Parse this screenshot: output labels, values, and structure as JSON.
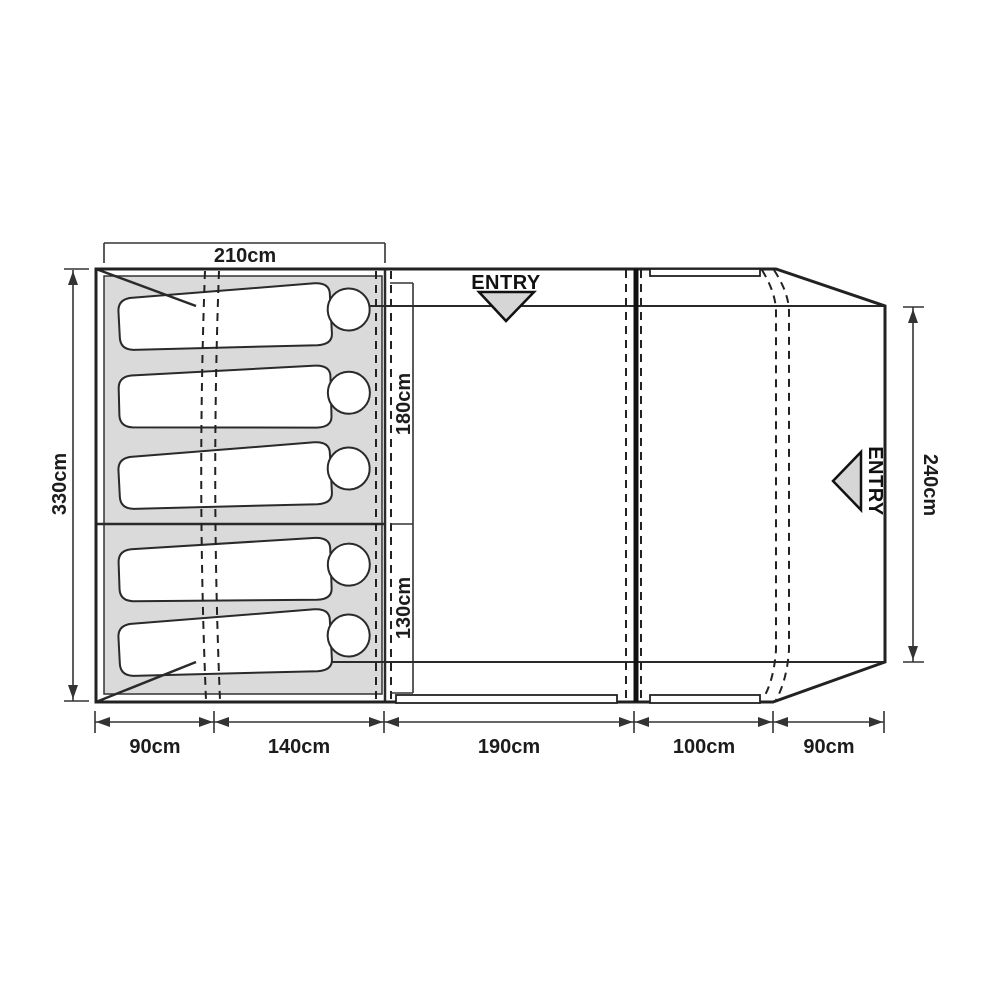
{
  "diagram": {
    "title": "tent floorplan",
    "colors": {
      "line": "#222222",
      "bedroom_fill": "#dadada",
      "entry_arrow_fill": "#d6d6d6",
      "background": "#ffffff",
      "text": "#1c1c1e"
    },
    "labels": {
      "top_width": "210cm",
      "outer_height": "330cm",
      "bedroom_depth_top": "180cm",
      "bedroom_depth_bottom": "130cm",
      "inner_height_right": "240cm",
      "bottom_widths": [
        "90cm",
        "140cm",
        "190cm",
        "100cm",
        "90cm"
      ],
      "entry_top": "ENTRY",
      "entry_side": "ENTRY"
    },
    "sleeper_count": "5"
  }
}
